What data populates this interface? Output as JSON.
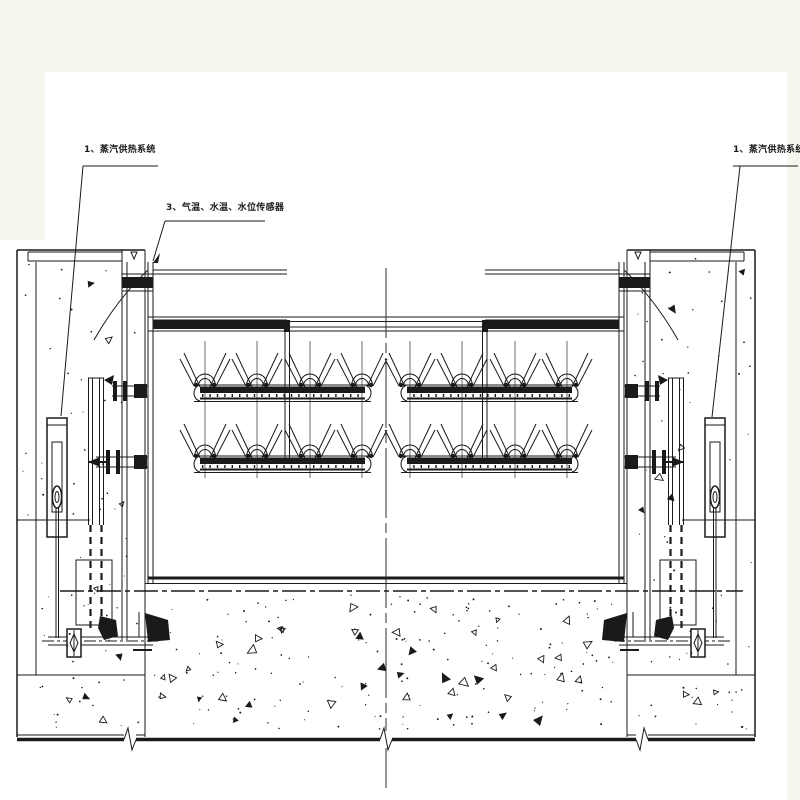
{
  "drawing": {
    "annotations": {
      "steam_left": {
        "text": "1、蒸汽供热系统"
      },
      "sensors": {
        "text": "3、气温、水温、水位传感器"
      },
      "steam_right": {
        "text": "1、蒸汽供热系统"
      }
    },
    "colors": {
      "ink": "#1a1a1a",
      "paper": "#ffffff",
      "margin": "#f5f7ee"
    }
  }
}
